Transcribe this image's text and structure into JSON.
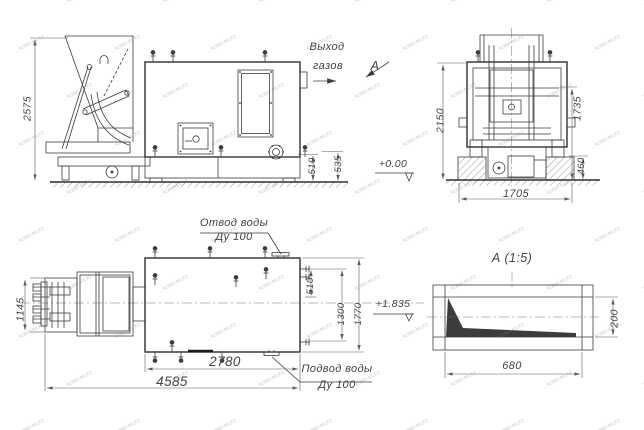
{
  "watermark": {
    "text": "kotel-kv.kz"
  },
  "side_view": {
    "dim_height": "2575",
    "dim_510": "510",
    "dim_535": "535"
  },
  "gas_outlet": {
    "line1": "Выход",
    "line2": "газов"
  },
  "section_arrow": {
    "label": "А"
  },
  "front_view": {
    "dim_height": "2150",
    "dim_1735": "1735",
    "dim_460": "460",
    "dim_1705": "1705"
  },
  "levels": {
    "zero": "+0.00",
    "water": "+1.835"
  },
  "plan_view": {
    "dim_1145": "1145",
    "dim_2780": "2780",
    "dim_4585": "4585",
    "dim_510": "510",
    "dim_1300": "1300",
    "dim_1770": "1770"
  },
  "water_outlet": {
    "line1": "Отвод воды",
    "line2": "Ду 100"
  },
  "water_supply": {
    "line1": "Подвод воды",
    "line2": "Ду 100"
  },
  "detail_a": {
    "title": "А (1:5)",
    "dim_680": "680",
    "dim_200": "200"
  }
}
